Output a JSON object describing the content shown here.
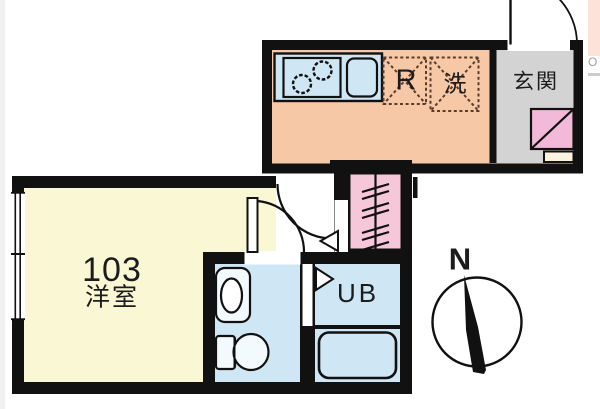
{
  "labels": {
    "room_number": "103",
    "room_type": "洋室",
    "entrance": "玄関",
    "refrigerator": "R",
    "washer": "洗",
    "unit_bath": "UB",
    "compass_north": "N",
    "edge_fragment": "O"
  },
  "colors": {
    "wall": "#111111",
    "kitchen_floor": "#f6c8a6",
    "water_blue": "#cfe6f4",
    "fixture_white": "#f3fafe",
    "entrance_gray": "#d3d3d3",
    "room_yellow": "#faf7d4",
    "shoe_pink": "#f3b9d8",
    "shoe_lower_cream": "#fbf2df",
    "stairs_pink": "#f6c7d8",
    "appliance_dash": "#5d3b2b",
    "edge_pink": "#fbe3da",
    "edge_line_gray": "#cccccc"
  }
}
